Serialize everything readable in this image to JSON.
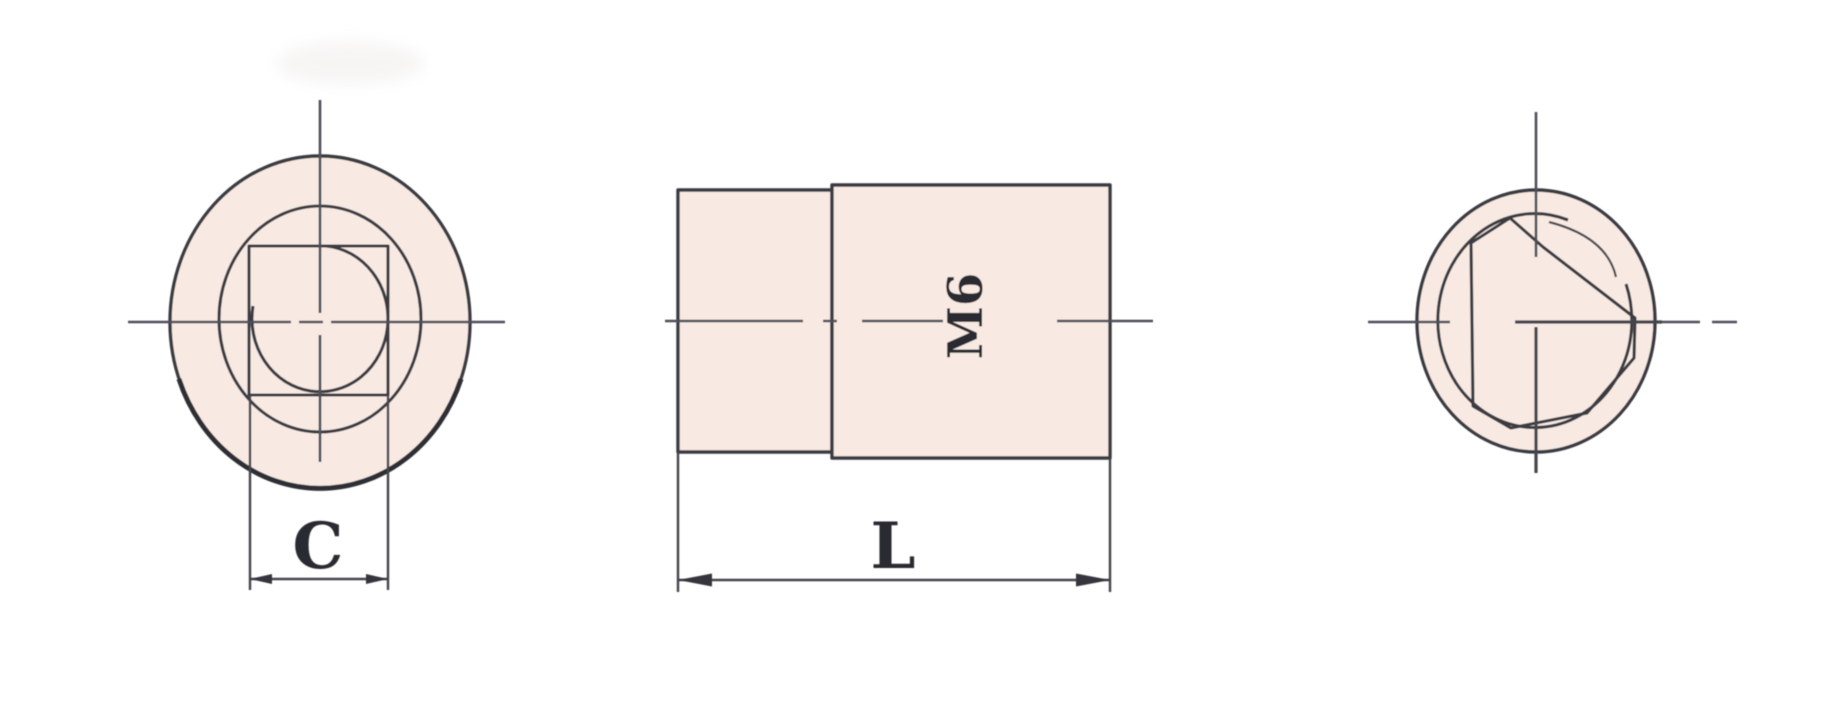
{
  "drawing": {
    "labels": {
      "width_dim": "C",
      "length_dim": "L",
      "thread_spec": "M6"
    },
    "colors": {
      "part_fill": "#f8eae2",
      "object_line": "#3b3b42",
      "centerline": "#50505a",
      "dimension_line": "#45454c",
      "dimension_text": "#2c2c30",
      "background": "#ffffff"
    }
  }
}
